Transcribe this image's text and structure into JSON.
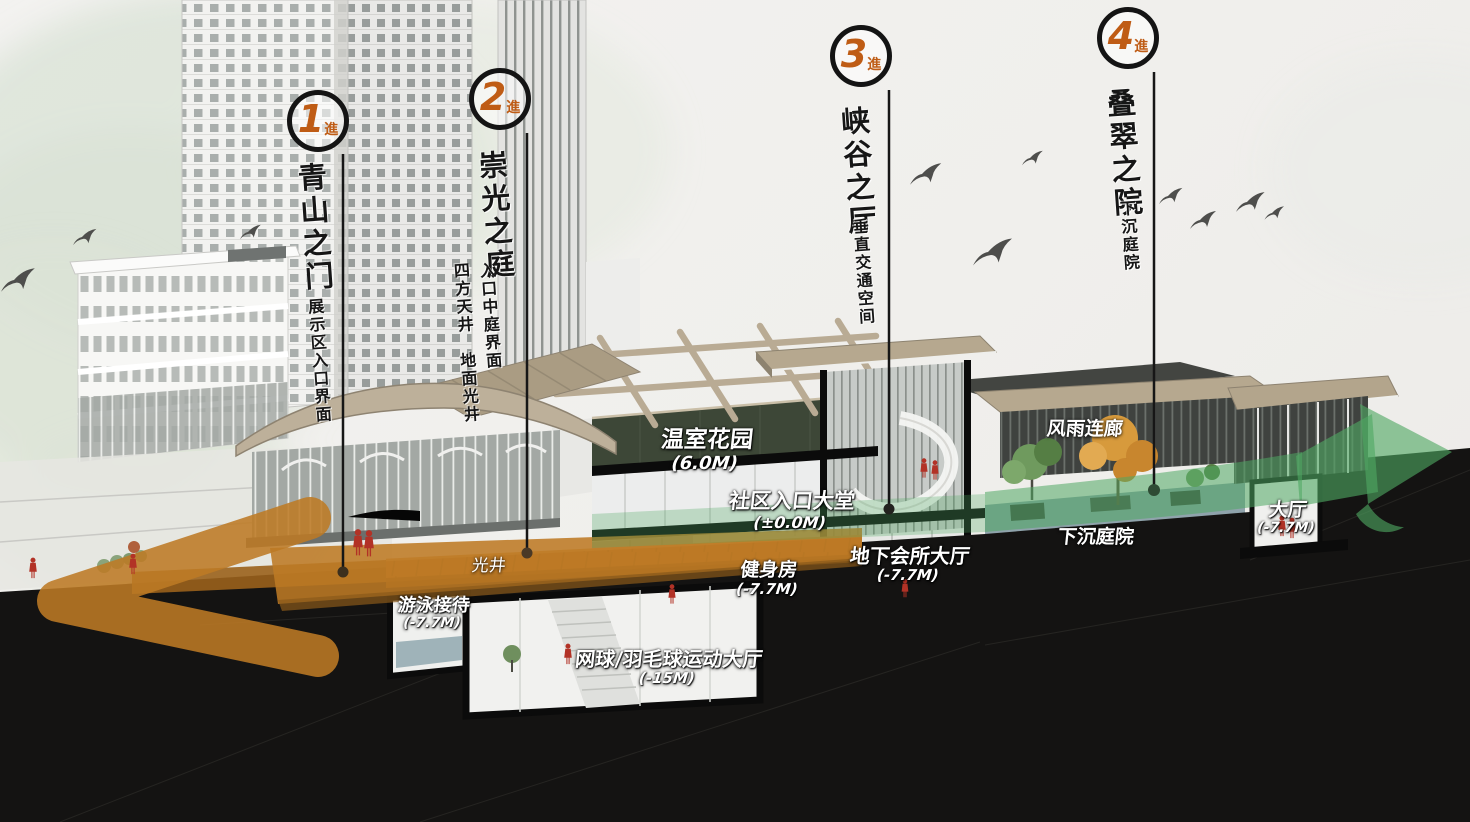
{
  "badges": [
    {
      "number": "1",
      "suffix": "進",
      "title": "青山之门",
      "subtitle": "展示区入口界面"
    },
    {
      "number": "2",
      "suffix": "進",
      "title": "崇光之庭",
      "subtitle_col1": "入口中庭界面",
      "subtitle_col2": "四方天井　地面光井"
    },
    {
      "number": "3",
      "suffix": "進",
      "title": "峡谷之厅",
      "subtitle": "垂直交通空间"
    },
    {
      "number": "4",
      "suffix": "進",
      "title": "叠翠之院",
      "subtitle": "下沉庭院"
    }
  ],
  "rooms": {
    "greenhouse": {
      "name": "温室花园",
      "level": "(6.0M)"
    },
    "community_lobby": {
      "name": "社区入口大堂",
      "level": "(±0.0M)"
    },
    "gym": {
      "name": "健身房",
      "level": "(-7.7M)"
    },
    "club_hall": {
      "name": "地下会所大厅",
      "level": "(-7.7M)"
    },
    "swim_reception": {
      "name": "游泳接待",
      "level": "(-7.7M)"
    },
    "tennis_hall": {
      "name": "网球/羽毛球运动大厅",
      "level": "(-15M)"
    },
    "hall": {
      "name": "大厅",
      "level": "(-7.7M)"
    }
  },
  "annotations": {
    "light_well": "光井",
    "covered_corridor": "风雨连廊",
    "sunken_courtyard": "下沉庭院"
  },
  "colors": {
    "accent_orange": "#bf5c15",
    "flow_orange": "#bd7a24",
    "flow_green": "#4fa863",
    "ink": "#141414"
  }
}
